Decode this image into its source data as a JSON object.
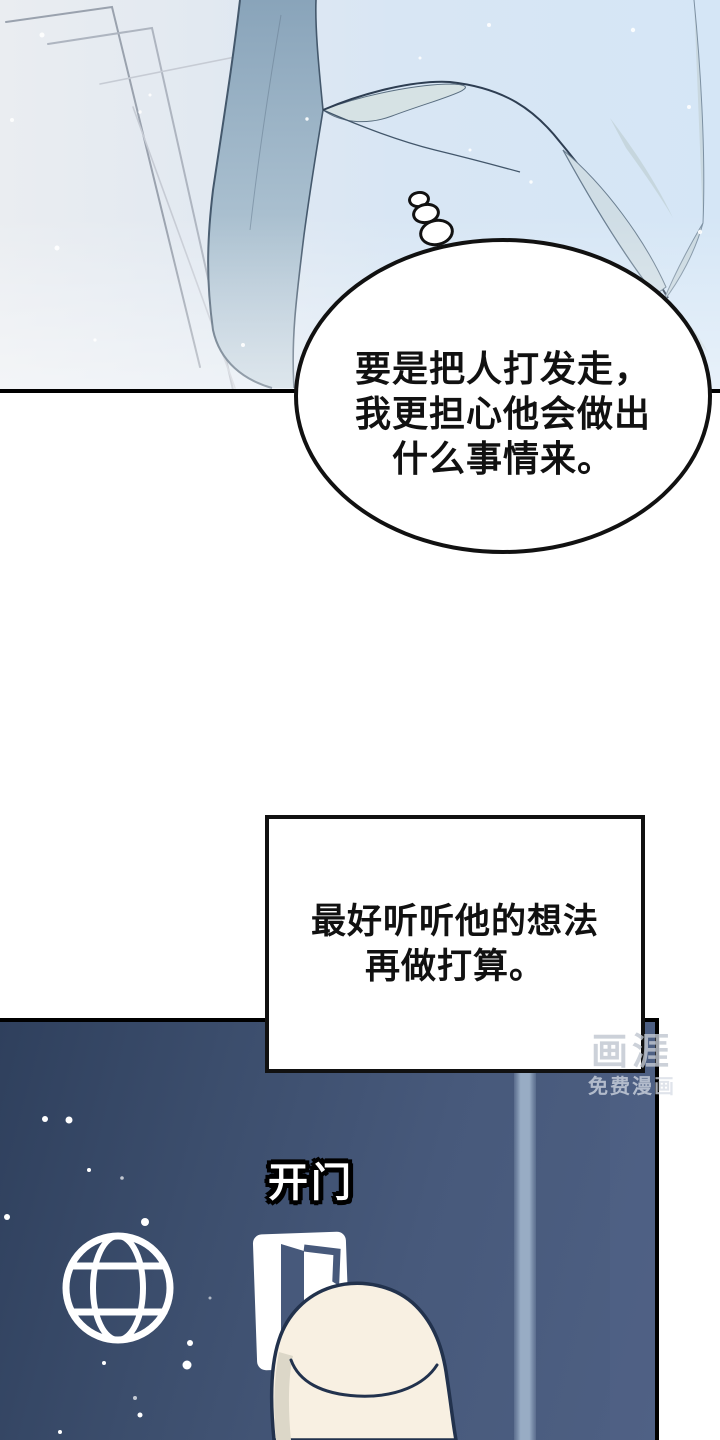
{
  "comic": {
    "thought_bubble": {
      "line1": "要是把人打发走，",
      "line2": "我更担心他会做出",
      "line3": "什么事情来。"
    },
    "narration_box": {
      "line1": "最好听听他的想法",
      "line2": "再做打算。"
    },
    "sfx": {
      "label": "开门"
    },
    "watermark": {
      "logo": "画涯",
      "subtitle": "免费漫画"
    },
    "colors": {
      "night_panel_blue": "#47597b",
      "day_light_blue": "#d8e6f4",
      "outline_black": "#000000",
      "finger_skin": "#f8f0e2",
      "icon_white": "#ffffff"
    }
  }
}
